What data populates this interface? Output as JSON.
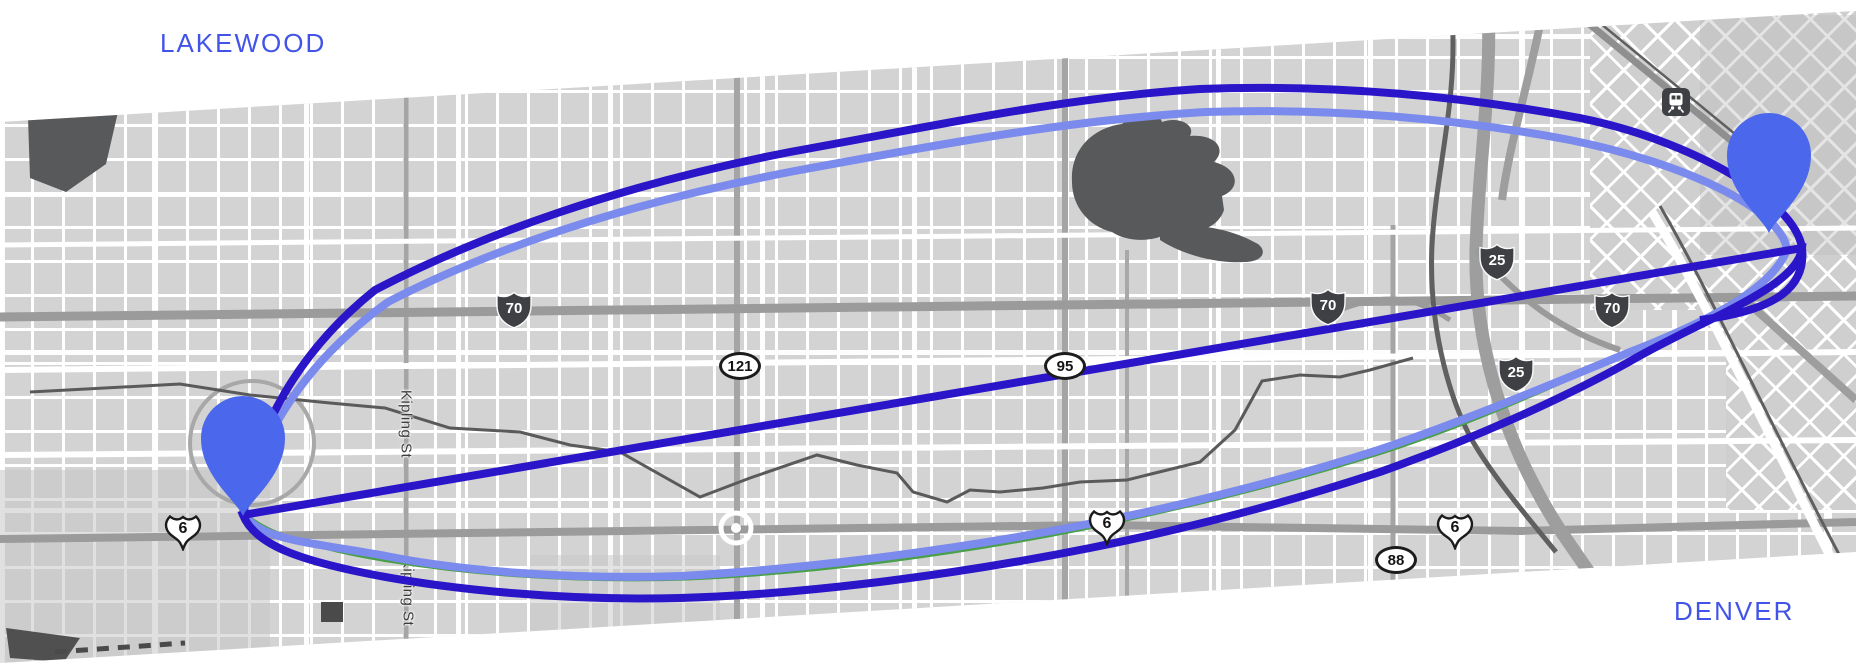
{
  "map_view": {
    "background_color": "#ffffff",
    "city_labels": [
      {
        "text": "LAKEWOOD",
        "color": "#4254e8"
      },
      {
        "text": "DENVER",
        "color": "#4254e8"
      }
    ],
    "route": {
      "outer_line_color": "#2a15c9",
      "inner_line_color": "#7b8aed",
      "trail_line_color": "#4aa04a",
      "marker_color": "#4b67eb",
      "markers": [
        {
          "id": "origin-pin",
          "area": "LAKEWOOD",
          "x": 243,
          "y": 516
        },
        {
          "id": "destination-pin",
          "area": "DENVER",
          "x": 1769,
          "y": 233
        }
      ]
    },
    "road_shields": [
      {
        "type": "interstate",
        "label": "70",
        "x": 514,
        "y": 310
      },
      {
        "type": "interstate",
        "label": "70",
        "x": 1328,
        "y": 307
      },
      {
        "type": "interstate",
        "label": "70",
        "x": 1612,
        "y": 310
      },
      {
        "type": "interstate",
        "label": "25",
        "x": 1497,
        "y": 262
      },
      {
        "type": "interstate",
        "label": "25",
        "x": 1516,
        "y": 374
      },
      {
        "type": "us",
        "label": "6",
        "x": 183,
        "y": 532
      },
      {
        "type": "us",
        "label": "6",
        "x": 1107,
        "y": 527
      },
      {
        "type": "us",
        "label": "6",
        "x": 1455,
        "y": 531
      },
      {
        "type": "state",
        "label": "121",
        "x": 740,
        "y": 366
      },
      {
        "type": "state",
        "label": "95",
        "x": 1065,
        "y": 366
      },
      {
        "type": "state",
        "label": "88",
        "x": 1396,
        "y": 560
      }
    ],
    "street_labels": [
      {
        "text": "Kipling St",
        "x": 406,
        "y": 424
      },
      {
        "text": "Kipling St",
        "x": 408,
        "y": 592
      }
    ],
    "transit_station_icon": "tram-station",
    "map_colors": {
      "block_fill": "#d3d3d3",
      "street": "#ffffff",
      "major_road": "#9b9b9b",
      "water_dark": "#58595b",
      "shield_dark": "#3e4043"
    }
  }
}
